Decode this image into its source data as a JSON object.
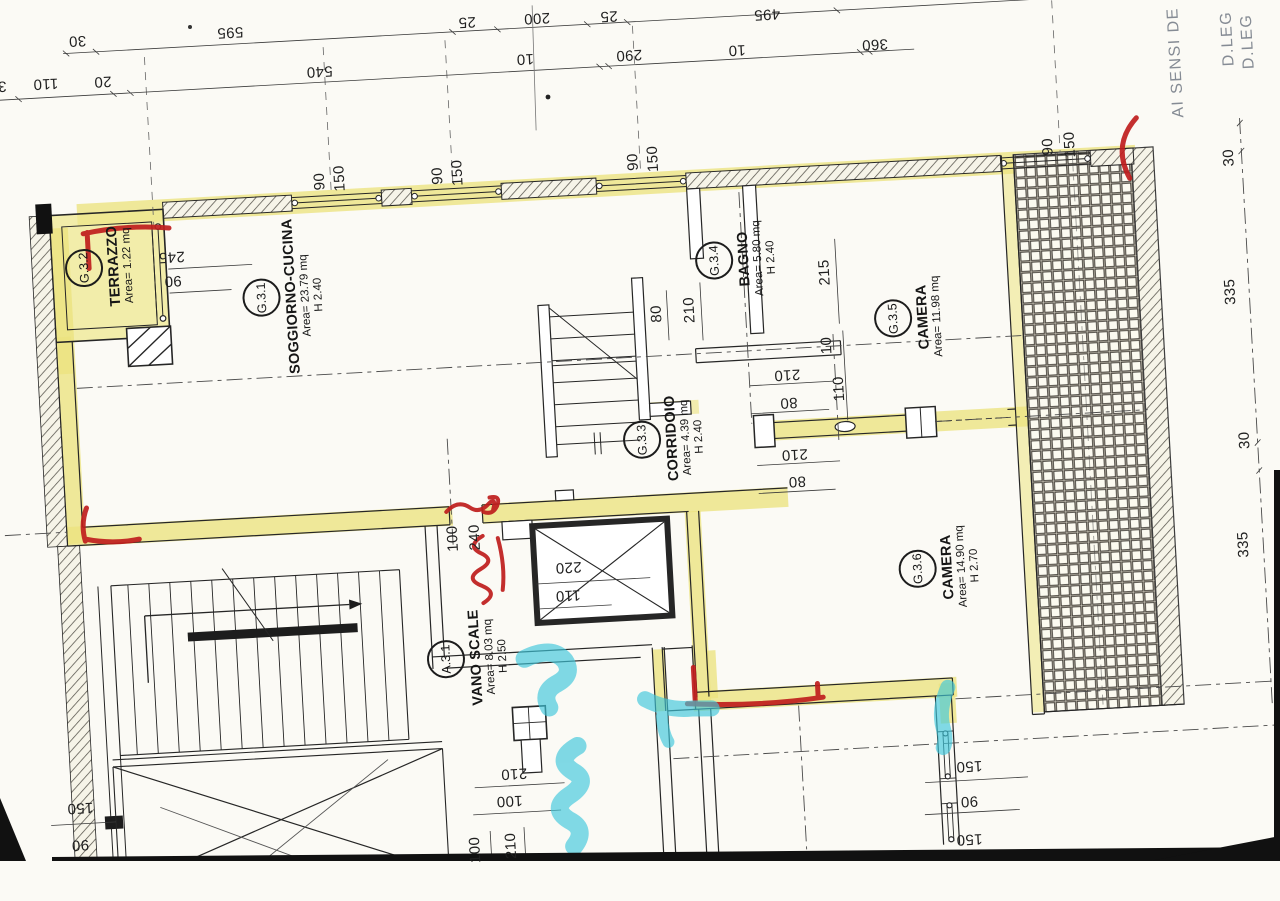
{
  "side_texts": [
    {
      "t": "AI SENSI DE",
      "x": 1196,
      "y": 93
    },
    {
      "t": "D.LEG",
      "x": 1249,
      "y": 72
    },
    {
      "t": "D.LEG",
      "x": 1269,
      "y": 76
    }
  ],
  "rooms": [
    {
      "code": "G.3.2",
      "name": "TERRAZZO",
      "area": "Area= 1.22 mq",
      "h": "",
      "x": 110,
      "y": 237
    },
    {
      "code": "G.3.1",
      "name": "SOGGIORNO-CUCINA",
      "area": "Area= 23.79 mq",
      "h": "H 2.40",
      "x": 292,
      "y": 277
    },
    {
      "code": "G.3.4",
      "name": "BAGNO",
      "area": "Area= 5.80 mq",
      "h": "H 2.40",
      "x": 746,
      "y": 265
    },
    {
      "code": "G.3.5",
      "name": "CAMERA",
      "area": "Area= 11.98 mq",
      "h": "",
      "x": 915,
      "y": 333
    },
    {
      "code": "G.3.3",
      "name": "CORRIDOIO",
      "area": "Area= 4.39 mq",
      "h": "H 2.40",
      "x": 664,
      "y": 440
    },
    {
      "code": "G.3.6",
      "name": "CAMERA",
      "area": "Area= 14.90 mq",
      "h": "H 2.70",
      "x": 932,
      "y": 584
    },
    {
      "code": "A.3.1",
      "name": "VANO SCALE",
      "area": "Area= 8.03 mq",
      "h": "H 2.50",
      "x": 456,
      "y": 648
    }
  ],
  "dimensions": [
    {
      "t": "30",
      "x": 100,
      "y": 10,
      "r": 180
    },
    {
      "t": "595",
      "x": 253,
      "y": 10,
      "r": 180
    },
    {
      "t": "25",
      "x": 490,
      "y": 13,
      "r": 180
    },
    {
      "t": "200",
      "x": 560,
      "y": 13,
      "r": 180
    },
    {
      "t": "25",
      "x": 632,
      "y": 15,
      "r": 180
    },
    {
      "t": "495",
      "x": 790,
      "y": 22,
      "r": 180
    },
    {
      "t": "30",
      "x": 18,
      "y": 51,
      "r": 180
    },
    {
      "t": "110",
      "x": 66,
      "y": 51,
      "r": 180
    },
    {
      "t": "20",
      "x": 123,
      "y": 52,
      "r": 180
    },
    {
      "t": "540",
      "x": 340,
      "y": 54,
      "r": 180
    },
    {
      "t": "10",
      "x": 546,
      "y": 53,
      "r": 180
    },
    {
      "t": "290",
      "x": 650,
      "y": 55,
      "r": 180
    },
    {
      "t": "10",
      "x": 758,
      "y": 56,
      "r": 180
    },
    {
      "t": "360",
      "x": 896,
      "y": 58,
      "r": 180
    },
    {
      "t": "90",
      "x": 334,
      "y": 164,
      "r": -90
    },
    {
      "t": "150",
      "x": 354,
      "y": 162,
      "r": -90
    },
    {
      "t": "90",
      "x": 452,
      "y": 165,
      "r": -90
    },
    {
      "t": "150",
      "x": 472,
      "y": 163,
      "r": -90
    },
    {
      "t": "90",
      "x": 648,
      "y": 162,
      "r": -90
    },
    {
      "t": "150",
      "x": 668,
      "y": 160,
      "r": -90
    },
    {
      "t": "90",
      "x": 1063,
      "y": 170,
      "r": -90
    },
    {
      "t": "150",
      "x": 1085,
      "y": 169,
      "r": -90
    },
    {
      "t": "245",
      "x": 182,
      "y": 231,
      "r": 180
    },
    {
      "t": "90",
      "x": 182,
      "y": 255,
      "r": 180
    },
    {
      "t": "80",
      "x": 663,
      "y": 315,
      "r": -90
    },
    {
      "t": "210",
      "x": 696,
      "y": 313,
      "r": -90
    },
    {
      "t": "215",
      "x": 833,
      "y": 283,
      "r": -90
    },
    {
      "t": "10",
      "x": 831,
      "y": 356,
      "r": -90
    },
    {
      "t": "110",
      "x": 841,
      "y": 400,
      "r": -90
    },
    {
      "t": "210",
      "x": 790,
      "y": 383,
      "r": 180
    },
    {
      "t": "80",
      "x": 790,
      "y": 411,
      "r": 180
    },
    {
      "t": "210",
      "x": 793,
      "y": 463,
      "r": 180
    },
    {
      "t": "80",
      "x": 794,
      "y": 490,
      "r": 180
    },
    {
      "t": "100",
      "x": 447,
      "y": 528,
      "r": -90
    },
    {
      "t": "240",
      "x": 469,
      "y": 528,
      "r": -90
    },
    {
      "t": "220",
      "x": 561,
      "y": 563,
      "r": 180
    },
    {
      "t": "110",
      "x": 559,
      "y": 591,
      "r": 180
    },
    {
      "t": "210",
      "x": 495,
      "y": 766,
      "r": 180
    },
    {
      "t": "100",
      "x": 489,
      "y": 793,
      "r": 180
    },
    {
      "t": "100",
      "x": 452,
      "y": 840,
      "r": -90
    },
    {
      "t": "210",
      "x": 488,
      "y": 838,
      "r": -90
    },
    {
      "t": "150",
      "x": 60,
      "y": 776,
      "r": 180
    },
    {
      "t": "90",
      "x": 58,
      "y": 813,
      "r": 180
    },
    {
      "t": "150",
      "x": 950,
      "y": 784,
      "r": 180
    },
    {
      "t": "90",
      "x": 948,
      "y": 819,
      "r": 180
    },
    {
      "t": "150",
      "x": 946,
      "y": 857,
      "r": 180
    },
    {
      "t": "30",
      "x": 1243,
      "y": 191,
      "r": -90
    },
    {
      "t": "335",
      "x": 1237,
      "y": 325,
      "r": -90
    },
    {
      "t": "30",
      "x": 1243,
      "y": 474,
      "r": -90
    },
    {
      "t": "335",
      "x": 1236,
      "y": 578,
      "r": -90
    }
  ],
  "colors": {
    "highlighter_yellow": "#ece37f",
    "pen_red": "#bf1d1d",
    "marker_cyan": "#3ec7db",
    "ink": "#262626"
  }
}
